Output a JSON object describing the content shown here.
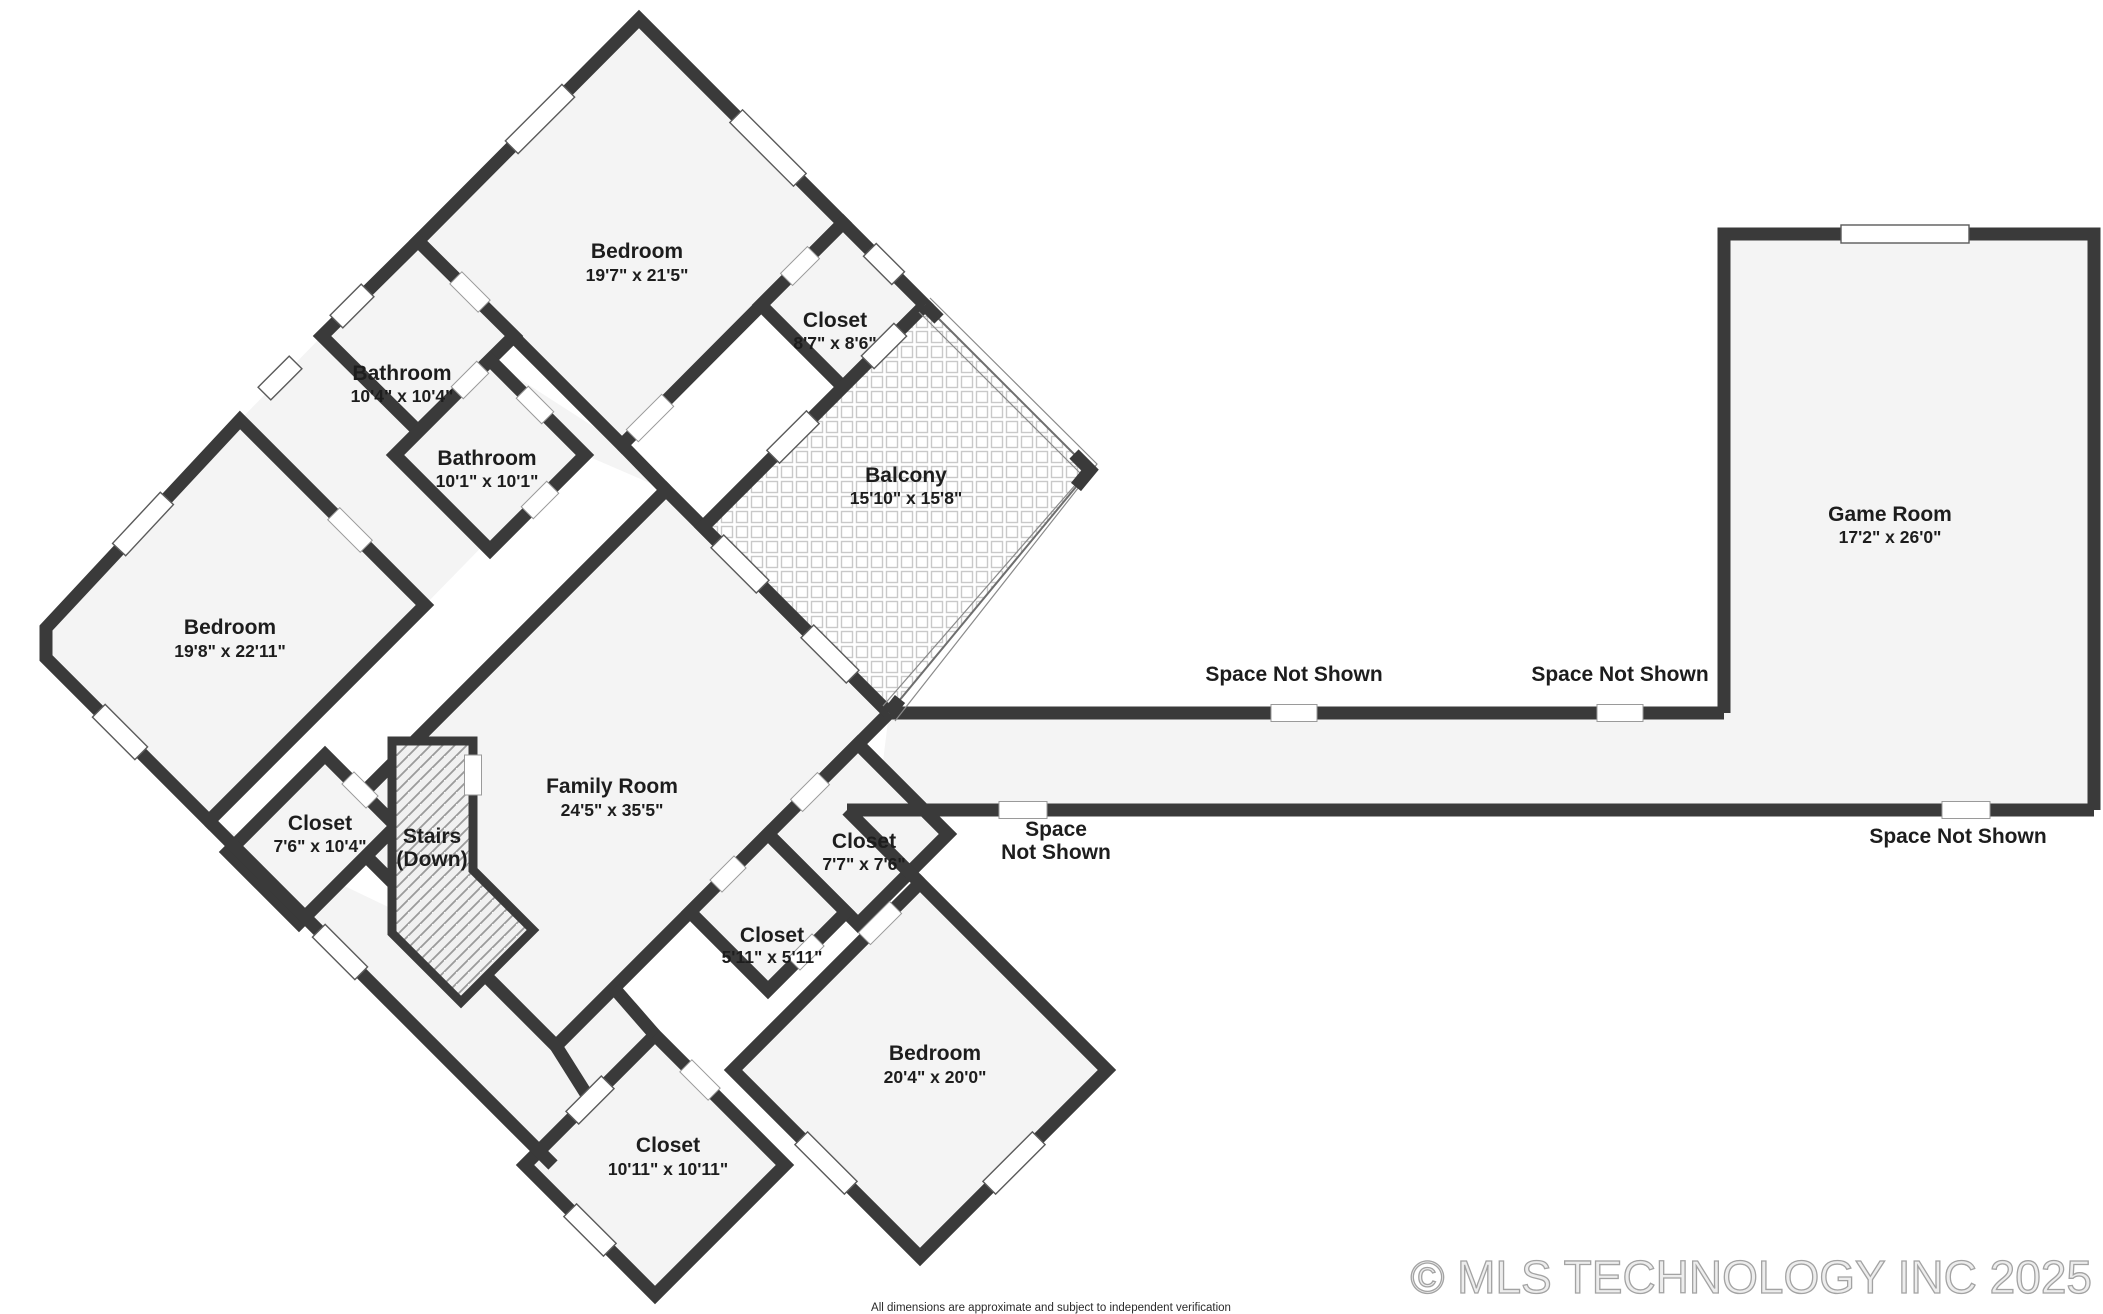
{
  "floorplan": {
    "rooms": {
      "bedroom_top": {
        "name": "Bedroom",
        "dims": "19'7\" x 21'5\""
      },
      "closet_top": {
        "name": "Closet",
        "dims": "8'7\" x 8'6\""
      },
      "bathroom_1": {
        "name": "Bathroom",
        "dims": "10'4\" x 10'4\""
      },
      "bathroom_2": {
        "name": "Bathroom",
        "dims": "10'1\" x 10'1\""
      },
      "balcony": {
        "name": "Balcony",
        "dims": "15'10\" x 15'8\""
      },
      "bedroom_left": {
        "name": "Bedroom",
        "dims": "19'8\" x 22'11\""
      },
      "closet_left": {
        "name": "Closet",
        "dims": "7'6\" x 10'4\""
      },
      "stairs": {
        "name": "Stairs",
        "dims": "(Down)"
      },
      "family_room": {
        "name": "Family Room",
        "dims": "24'5\" x 35'5\""
      },
      "closet_mid": {
        "name": "Closet",
        "dims": "7'7\" x 7'6\""
      },
      "closet_small": {
        "name": "Closet",
        "dims": "5'11\" x 5'11\""
      },
      "bedroom_bottom": {
        "name": "Bedroom",
        "dims": "20'4\" x 20'0\""
      },
      "closet_bottom": {
        "name": "Closet",
        "dims": "10'11\" x 10'11\""
      },
      "game_room": {
        "name": "Game Room",
        "dims": "17'2\" x 26'0\""
      }
    },
    "annotations": {
      "space_not_shown_1": "Space Not Shown",
      "space_not_shown_2": "Space Not Shown",
      "space_not_shown_3_line1": "Space",
      "space_not_shown_3_line2": "Not Shown",
      "space_not_shown_4": "Space Not Shown"
    },
    "colors": {
      "wall": "#3a3a3a",
      "floor": "#f4f4f4",
      "label": "#1d1d1d",
      "copyright_gray": "#a3a3a3"
    }
  },
  "footer": {
    "copyright": "© MLS TECHNOLOGY INC 2025",
    "disclaimer": "All dimensions are approximate and subject to independent verification"
  }
}
